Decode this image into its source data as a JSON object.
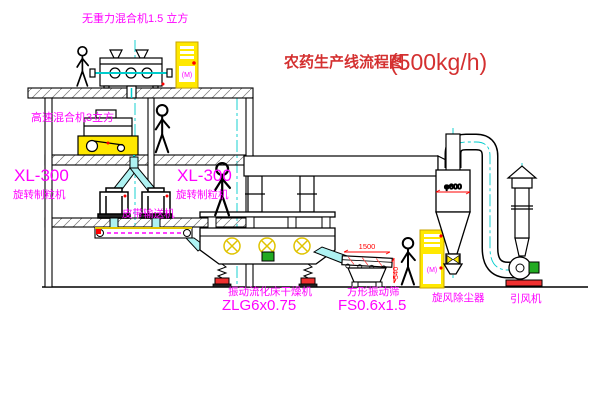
{
  "title": {
    "name": "农药生产线流程图",
    "capacity": "(500kg/h)"
  },
  "equipment_labels": {
    "gravity_mixer": "无重力混合机1.5 立方",
    "high_speed_mixer": "高速混合机3立方",
    "granulator_left_model": "XL-300",
    "granulator_left_name": "旋转制粒机",
    "granulator_right_model": "XL-300",
    "granulator_right_name": "旋转制粒机",
    "belt_conveyor": "皮带输送机",
    "fluid_bed_dryer": "振动流化床干燥机",
    "fluid_bed_dryer_model": "ZLG6x0.75",
    "vibrating_screen": "方形振动筛",
    "vibrating_screen_model": "FS0.6x1.5",
    "cyclone": "旋风除尘器",
    "induced_draft_fan": "引风机"
  },
  "dimensions": {
    "cyclone_diameter": "φ600",
    "screen_length": "1500",
    "screen_height": "540"
  },
  "control_cabinet_marks": {
    "cabinet_top": "(M)",
    "cabinet_right": "(M)"
  },
  "colors": {
    "label_magenta": "#ff00ff",
    "title_red": "#d43030",
    "dimension_red": "#ff0000",
    "line_yellow": "#ffe800",
    "centerline_cyan": "#00cccc",
    "motor_green": "#22aa22",
    "line_black": "#000000",
    "background": "#ffffff"
  }
}
